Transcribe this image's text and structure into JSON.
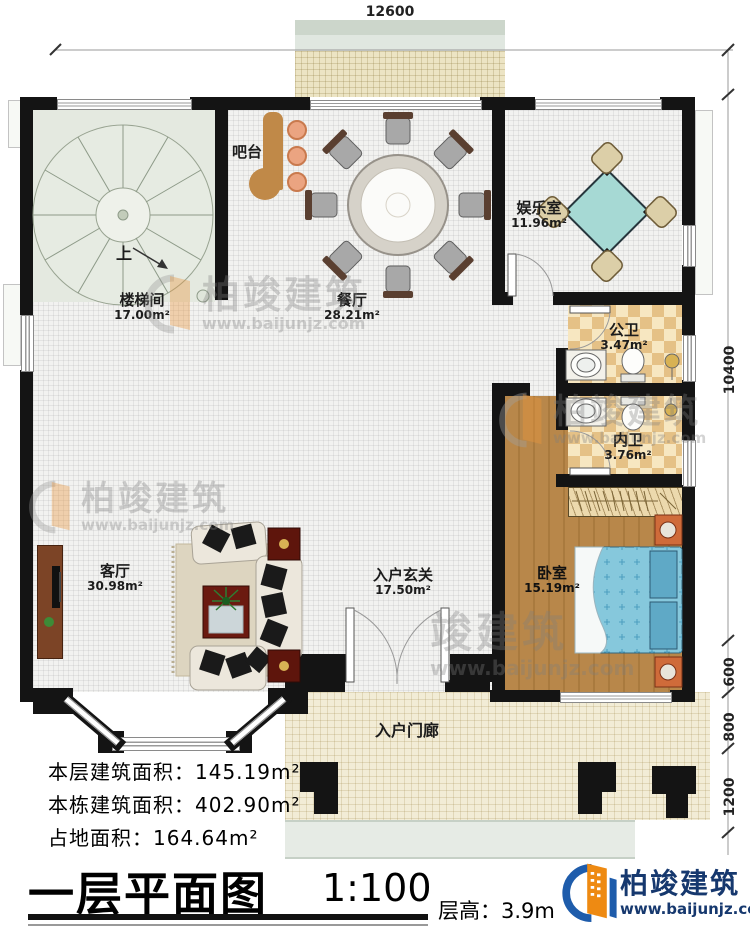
{
  "dimensions": {
    "top": "12600",
    "right_10400": "10400",
    "right_600": "600",
    "right_800": "800",
    "right_1200": "1200"
  },
  "rooms": {
    "stairwell": {
      "name": "楼梯间",
      "area": "17.00m²"
    },
    "stair_direction": "上",
    "bar": {
      "name": "吧台"
    },
    "dining": {
      "name": "餐厅",
      "area": "28.21m²"
    },
    "recreation": {
      "name": "娱乐室",
      "area": "11.96m²"
    },
    "public_bath": {
      "name": "公卫",
      "area": "3.47m²"
    },
    "private_bath": {
      "name": "内卫",
      "area": "3.76m²"
    },
    "bedroom": {
      "name": "卧室",
      "area": "15.19m²"
    },
    "living": {
      "name": "客厅",
      "area": "30.98m²"
    },
    "foyer": {
      "name": "入户玄关",
      "area": "17.50m²"
    },
    "porch": {
      "name": "入户门廊"
    }
  },
  "stats": {
    "floor_area": "本层建筑面积：145.19m²",
    "building_area": "本栋建筑面积：402.90m²",
    "land_area": "占地面积：164.64m²"
  },
  "titleblock": {
    "title": "一层平面图",
    "scale": "1:100",
    "floor_height": "层高：3.9m"
  },
  "brand": {
    "name": "柏竣建筑",
    "url": "www.baijunjz.com"
  },
  "watermark": {
    "name": "柏竣建筑",
    "short": "竣建筑",
    "url": "www.baijunjz.com"
  },
  "colors": {
    "wall": "#141414",
    "wood": "#b8874a",
    "bed": "#86c8dc",
    "bath_tile": "#e5c186",
    "brand_blue": "#1e5cab",
    "brand_orange": "#ee8a12"
  }
}
